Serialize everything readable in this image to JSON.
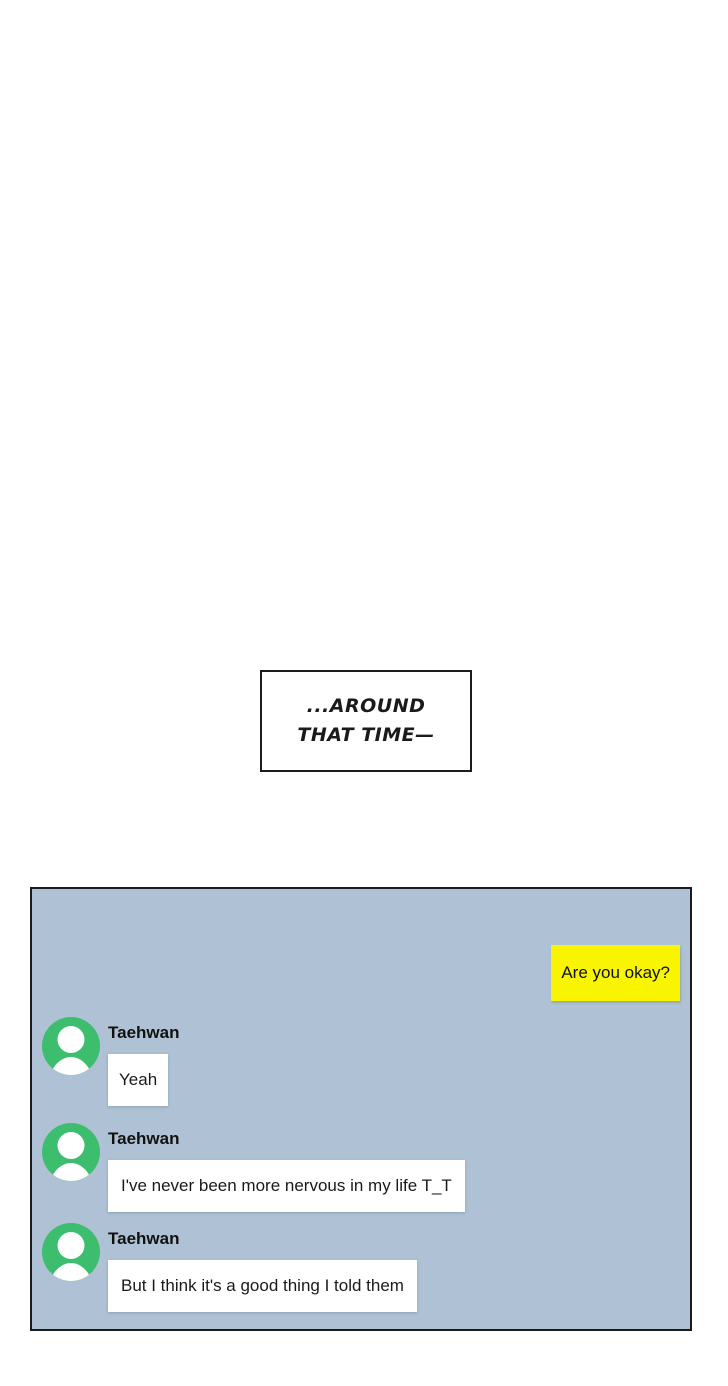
{
  "caption": {
    "text": "...AROUND\nTHAT TIME—"
  },
  "chat_panel": {
    "background_color": "#afc2d5",
    "outgoing_message": {
      "text": "Are you okay?",
      "bubble_color": "#f9f500"
    },
    "incoming_messages": [
      {
        "sender": "Taehwan",
        "text": "Yeah"
      },
      {
        "sender": "Taehwan",
        "text": "I've never been more nervous in my life T_T"
      },
      {
        "sender": "Taehwan",
        "text": "But I think it's a good thing I told them"
      }
    ],
    "avatar_color": "#3cbe6e"
  }
}
